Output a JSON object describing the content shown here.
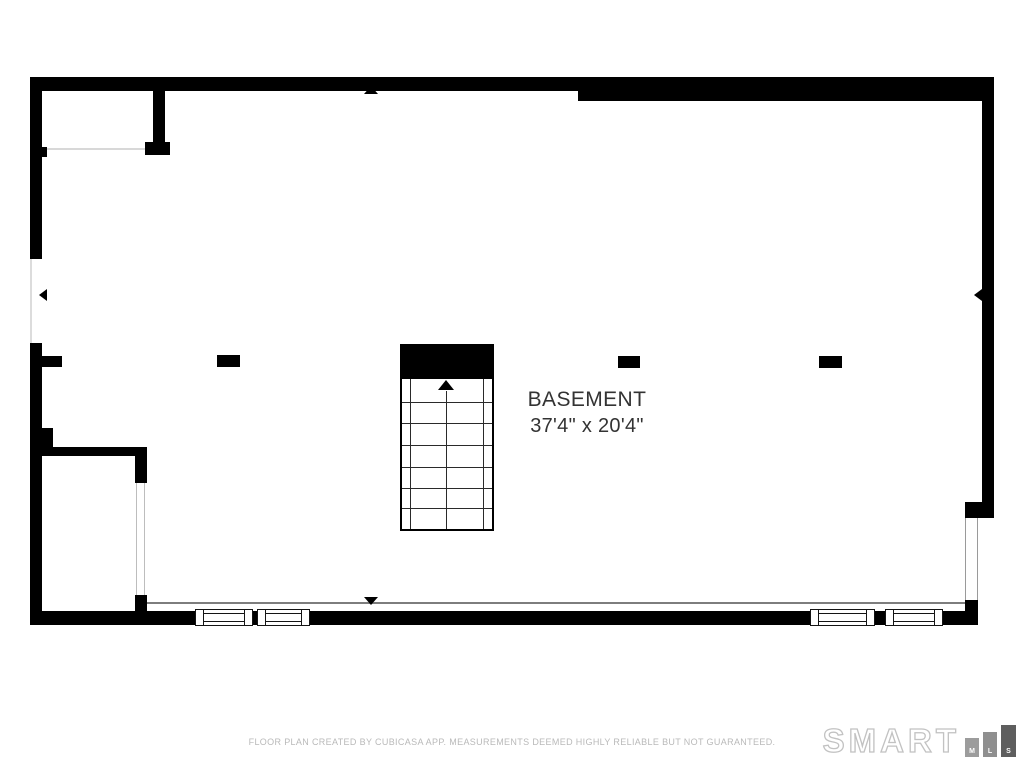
{
  "room": {
    "name": "BASEMENT",
    "dimensions": "37'4\" x 20'4\""
  },
  "footer": {
    "disclaimer": "FLOOR PLAN CREATED BY CUBICASA APP. MEASUREMENTS DEEMED HIGHLY RELIABLE BUT NOT GUARANTEED."
  },
  "logo": {
    "brand": "SMART",
    "mls_letters": [
      "M",
      "L",
      "S"
    ]
  },
  "colors": {
    "wall": "#000000",
    "opening_line": "#9a9a9a",
    "floor_edge_line": "#7d7d7d",
    "label_text": "#333333",
    "footer_text": "#b9b9b9",
    "logo_outline": "#c2c2c2",
    "logo_bar_light": "#9c9c9c",
    "logo_bar_dark": "#5e5e5e"
  }
}
